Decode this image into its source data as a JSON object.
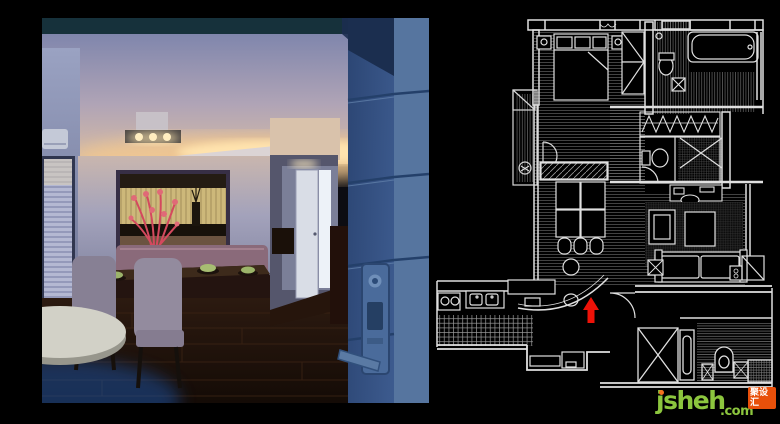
{
  "scene": {
    "background_color": "#000000",
    "layout": "interior photograph on left, CAD floor plan on right"
  },
  "photo": {
    "subject": "dining room interior with cove-lit ceiling, dining table, hallway and blue door",
    "accent_colors": {
      "cove_light": "#f6d49c",
      "ceiling": "#8a8fb4",
      "floor": "#241510",
      "flowers": "#d4495e",
      "door": "#3f5d8c"
    }
  },
  "floorplan": {
    "style": "white CAD linework on black",
    "line_color": "#e0e0e0",
    "marker": {
      "type": "arrow-up",
      "color": "#ee1208"
    }
  },
  "watermark": {
    "brand": "jsheh",
    "tld": ".com",
    "badge": "聚设汇",
    "brand_color": "#8cc63e",
    "badge_background": "#e8500a",
    "dot_color": "#f4711f"
  }
}
